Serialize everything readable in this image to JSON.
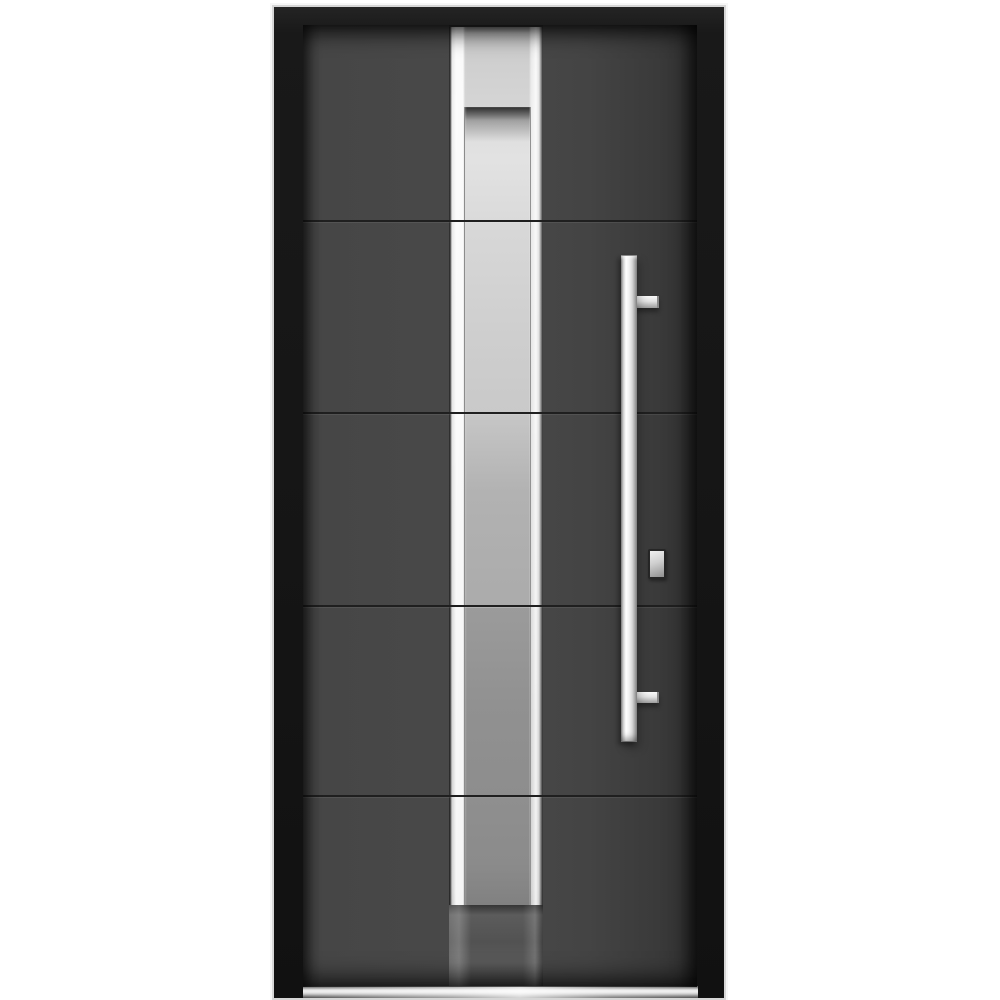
{
  "scene": {
    "type": "product-photo",
    "subject": "Modern single front entry door with black frame, graphite-gray slab, centered stainless-steel strip with frosted glass insert, long vertical pull handle, keyed lock and stainless threshold",
    "background_color": "#ffffff"
  },
  "door": {
    "frame_color": "#1a1a1a",
    "frame_outline_color": "#d6d6d6",
    "slab_color": "#494949",
    "slab_shadow_color": "#2f2f2f",
    "groove_color": "#1f1f1f",
    "panel_rows": 5,
    "groove_count": 4
  },
  "steel_strip": {
    "steel_light": "#f5f5f5",
    "steel_mid": "#cccccc",
    "steel_dark": "#8c8c8c",
    "lower_section_color": "#525252"
  },
  "glass": {
    "style": "frosted",
    "glass_top": "#e2e2e2",
    "glass_mid": "#ababab",
    "glass_low": "#8d8d8d",
    "bands": 5
  },
  "hardware": {
    "handle_type": "vertical-bar-pull",
    "handle_color": "#e9e9e9",
    "bracket_count": 2,
    "lock_type": "cylinder-cover",
    "threshold_color": "#ededed"
  }
}
